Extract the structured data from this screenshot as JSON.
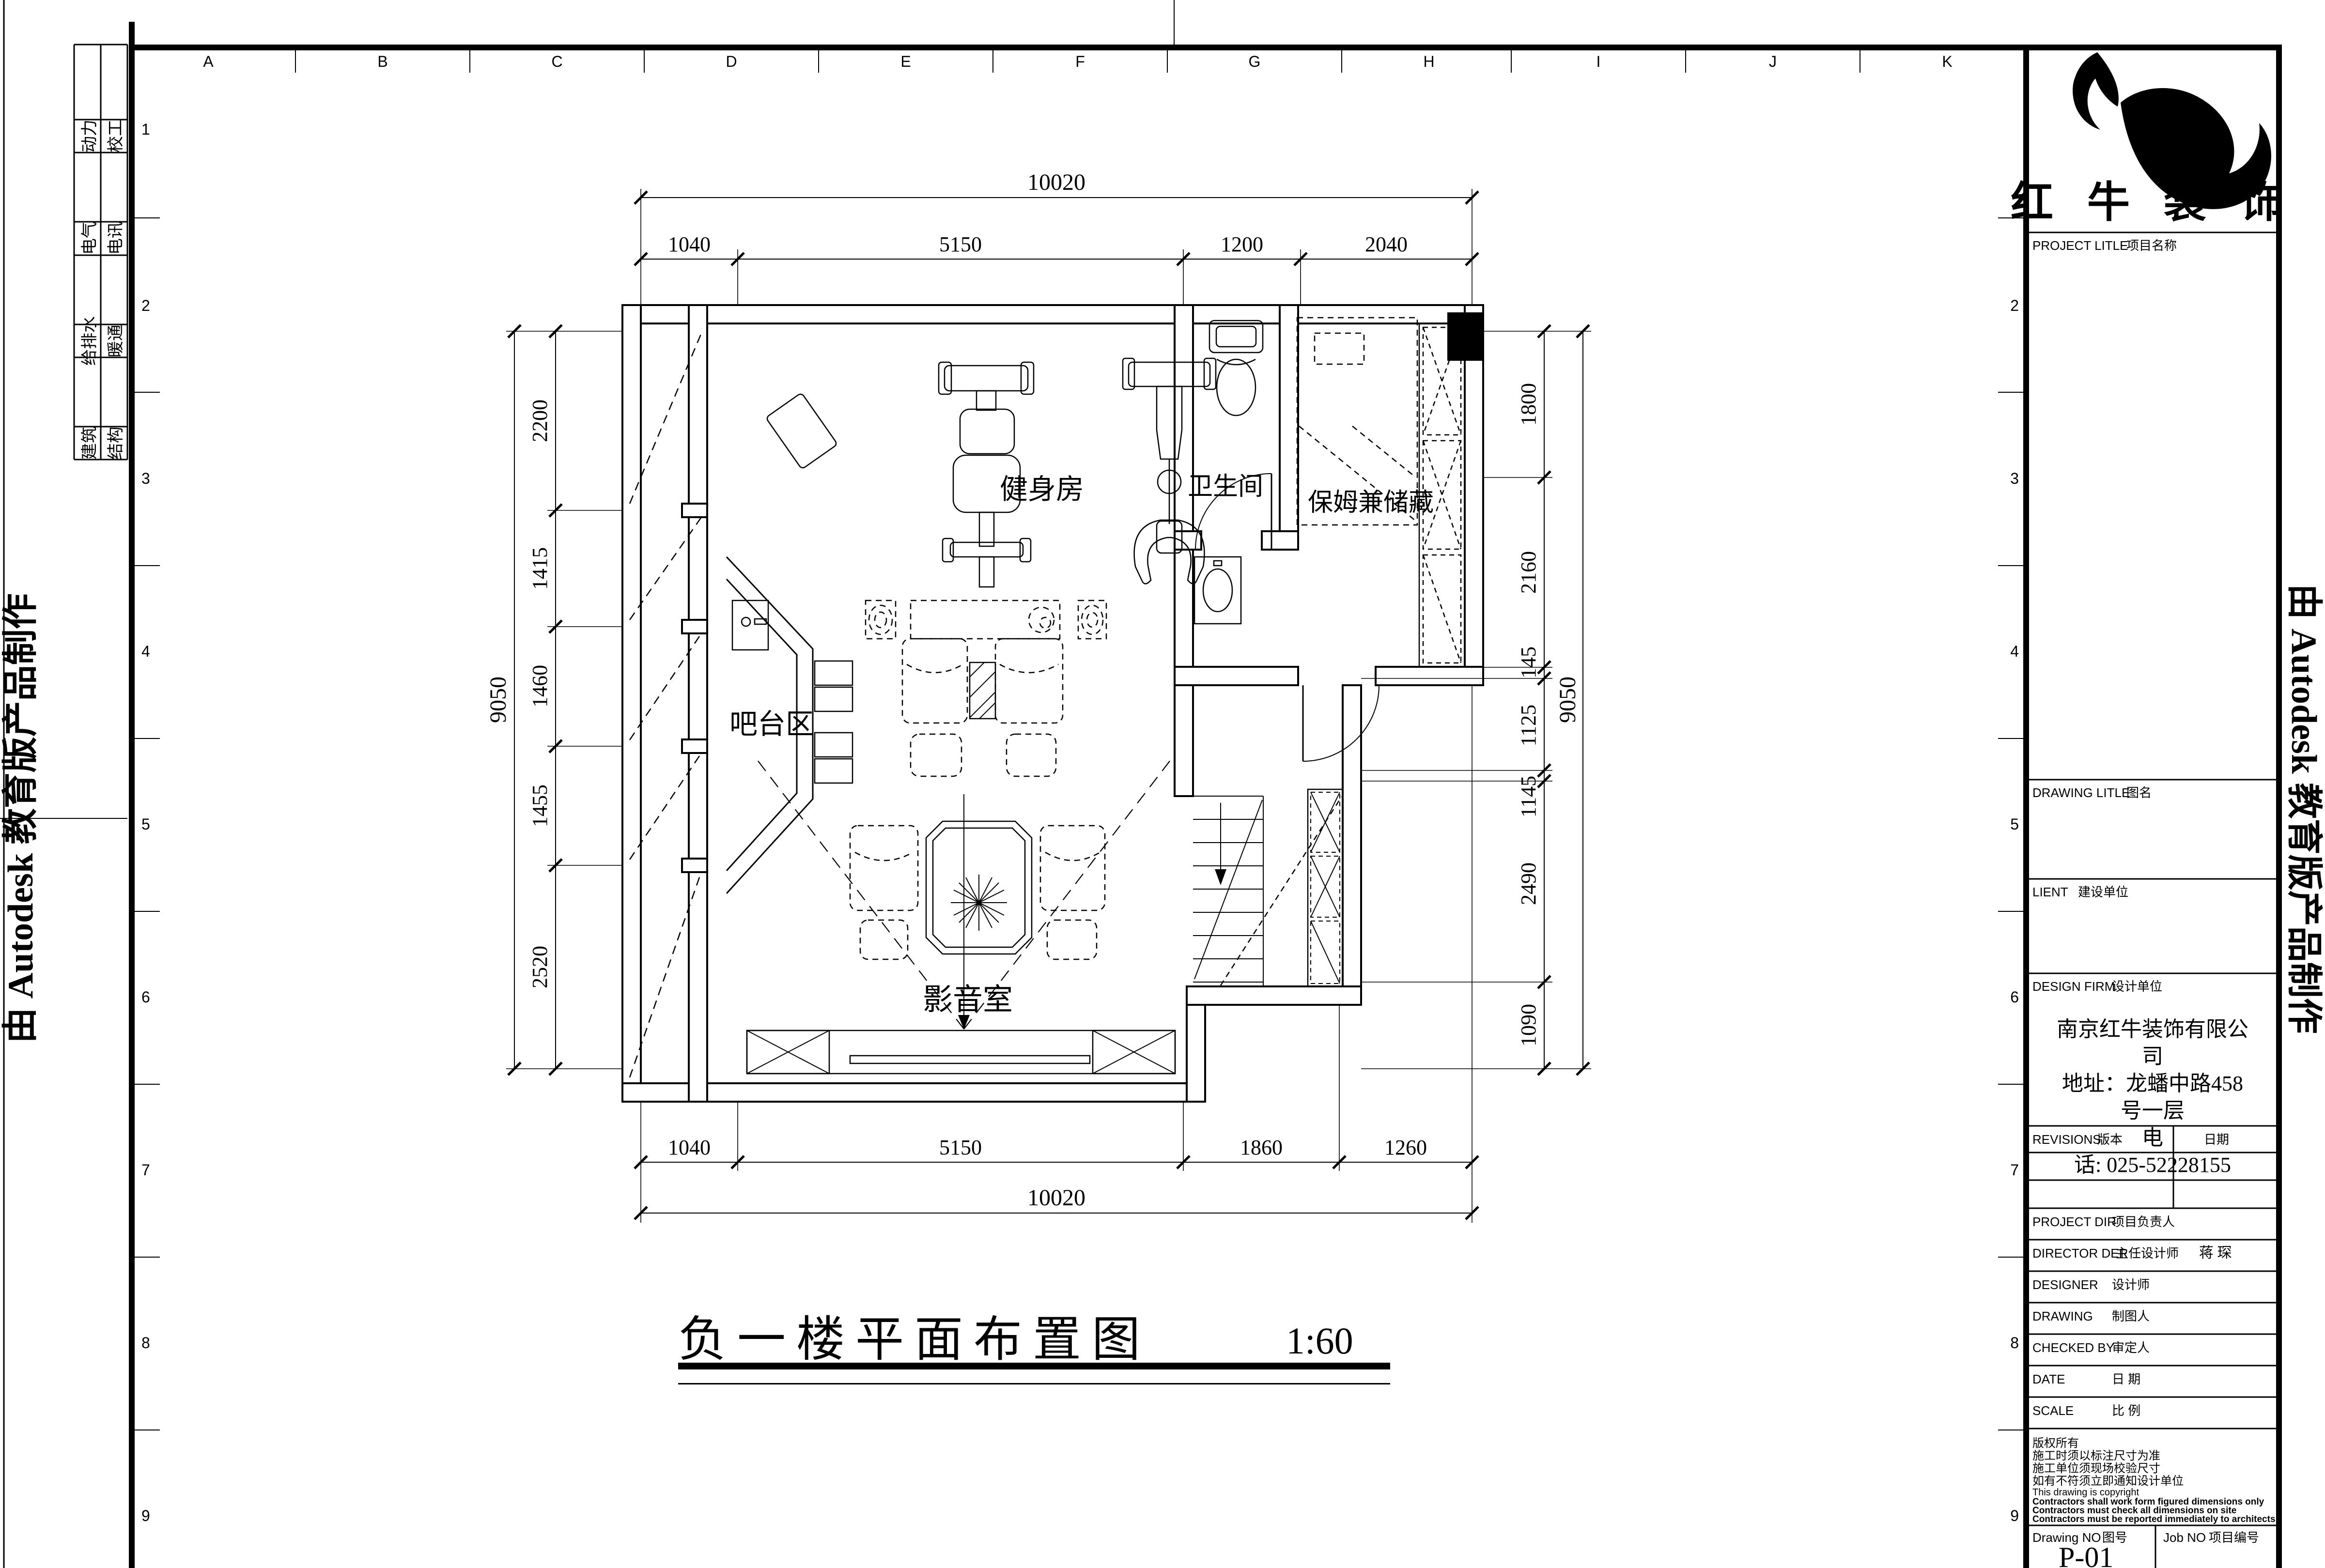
{
  "colors": {
    "ink": "#000000",
    "paper": "#ffffff"
  },
  "watermark": "由 Autodesk 教育版产品制作",
  "grid": {
    "letters": [
      "A",
      "B",
      "C",
      "D",
      "E",
      "F",
      "G",
      "H",
      "I",
      "J",
      "K"
    ],
    "rows": [
      "1",
      "2",
      "3",
      "4",
      "5",
      "6",
      "7",
      "8",
      "9"
    ]
  },
  "stamp": {
    "col1": [
      "动力",
      "电气",
      "给排水",
      "建筑"
    ],
    "col2": [
      "校工",
      "电讯",
      "暖通",
      "结构"
    ]
  },
  "plan": {
    "rooms": {
      "gym": "健身房",
      "bath": "卫生间",
      "nanny": "保姆兼储藏",
      "bar": "吧台区",
      "media": "影音室"
    },
    "dims": {
      "top_total": "10020",
      "top": [
        "1040",
        "5150",
        "1200",
        "2040"
      ],
      "bottom": [
        "1040",
        "5150",
        "1860",
        "1260"
      ],
      "bottom_total": "10020",
      "left_total": "9050",
      "left": [
        "2200",
        "1415",
        "1460",
        "1455",
        "2520"
      ],
      "right": [
        "1800",
        "2160",
        "145",
        "1125",
        "1145",
        "2490",
        "1090"
      ],
      "right_total": "9050"
    }
  },
  "title": {
    "main": "负一楼平面布置图",
    "scale": "1:60"
  },
  "titleblock": {
    "brand": "红 牛 装 饰",
    "project_title": {
      "en": "PROJECT LITLE",
      "cn": "项目名称"
    },
    "drawing_title": {
      "en": "DRAWING LITLE",
      "cn": "图名"
    },
    "client": {
      "en": "LIENT",
      "cn": "建设单位"
    },
    "design_firm": {
      "en": "DESIGN FIRM",
      "cn": "设计单位"
    },
    "revisions": {
      "en": "REVISIONS",
      "cn": "版本"
    },
    "rev_date": "日期",
    "rows": [
      {
        "en": "PROJECT DIR",
        "cn": "项目负责人",
        "value": ""
      },
      {
        "en": "DIRECTOR DER",
        "cn": "主任设计师",
        "value": "蒋  琛"
      },
      {
        "en": "DESIGNER",
        "cn": "设计师",
        "value": ""
      },
      {
        "en": "DRAWING",
        "cn": "制图人",
        "value": ""
      },
      {
        "en": "CHECKED BY",
        "cn": "审定人",
        "value": ""
      },
      {
        "en": "DATE",
        "cn": "日  期",
        "value": ""
      },
      {
        "en": "SCALE",
        "cn": "比  例",
        "value": ""
      }
    ],
    "firm_info": [
      "南京红牛装饰有限公",
      "司",
      "地址：龙蟠中路458",
      "号一层",
      "电",
      "话: 025-52228155"
    ],
    "notes": [
      "版权所有",
      "施工时须以标注尺寸为准",
      "施工单位须现场校验尺寸",
      "如有不符须立即通知设计单位",
      "This drawing is copyright",
      "Contractors shall work form figured dimensions only",
      "Contractors must check all dimensions on site",
      "Contractors must be reported immediately to architects"
    ],
    "drawing_no": {
      "en": "Drawing NO",
      "cn": "图号",
      "value": "P-01"
    },
    "job_no": {
      "en": "Job NO",
      "cn": "项目编号"
    }
  }
}
